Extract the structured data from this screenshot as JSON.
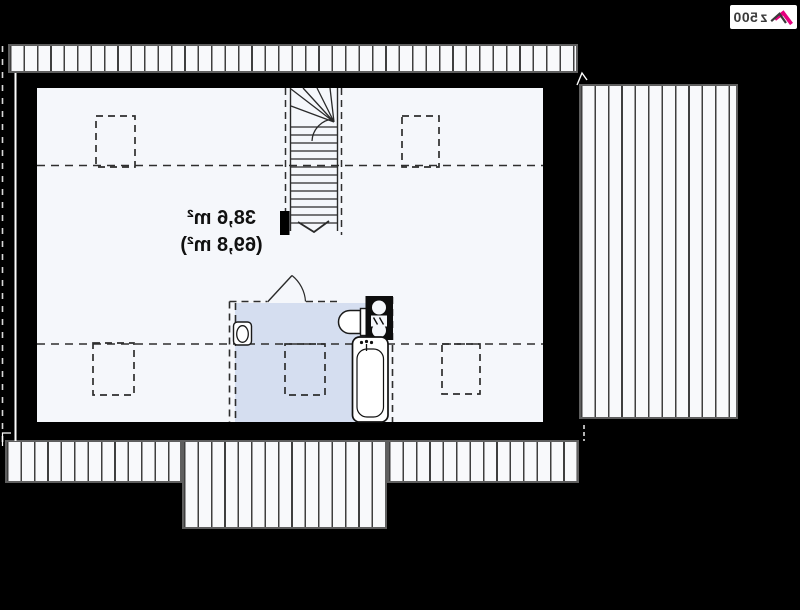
{
  "display": {
    "mirrored_text": true
  },
  "area_label": {
    "line1": "38,6 m²",
    "line2": "(69,8 m²)"
  },
  "logo": {
    "accent_text": "z",
    "rest_text": "500"
  },
  "colors": {
    "bg": "#000000",
    "floor": "#f5f7fb",
    "bath": "#d5def0",
    "line": "#2e2e2e",
    "strip_bg": "#f8f9fb",
    "strip_line": "#3f3f3f",
    "strip_border": "#5f5f5f",
    "accent": "#e5007e",
    "logo_text": "#3a3a3a",
    "white_line": "#ffffff"
  },
  "fixtures": {
    "staircase": "winder-stair-with-direction-arrow",
    "bathtub": "double-outline-rounded-rect",
    "toilet": "rounded-rect-with-oval",
    "washbasin": "half-round-basin",
    "appliance_column": "black-box-two-white-circles",
    "door": "quarter-arc-swing",
    "roof_windows": "dashed-rectangle",
    "eaves_and_terrace": "striped-bands"
  }
}
